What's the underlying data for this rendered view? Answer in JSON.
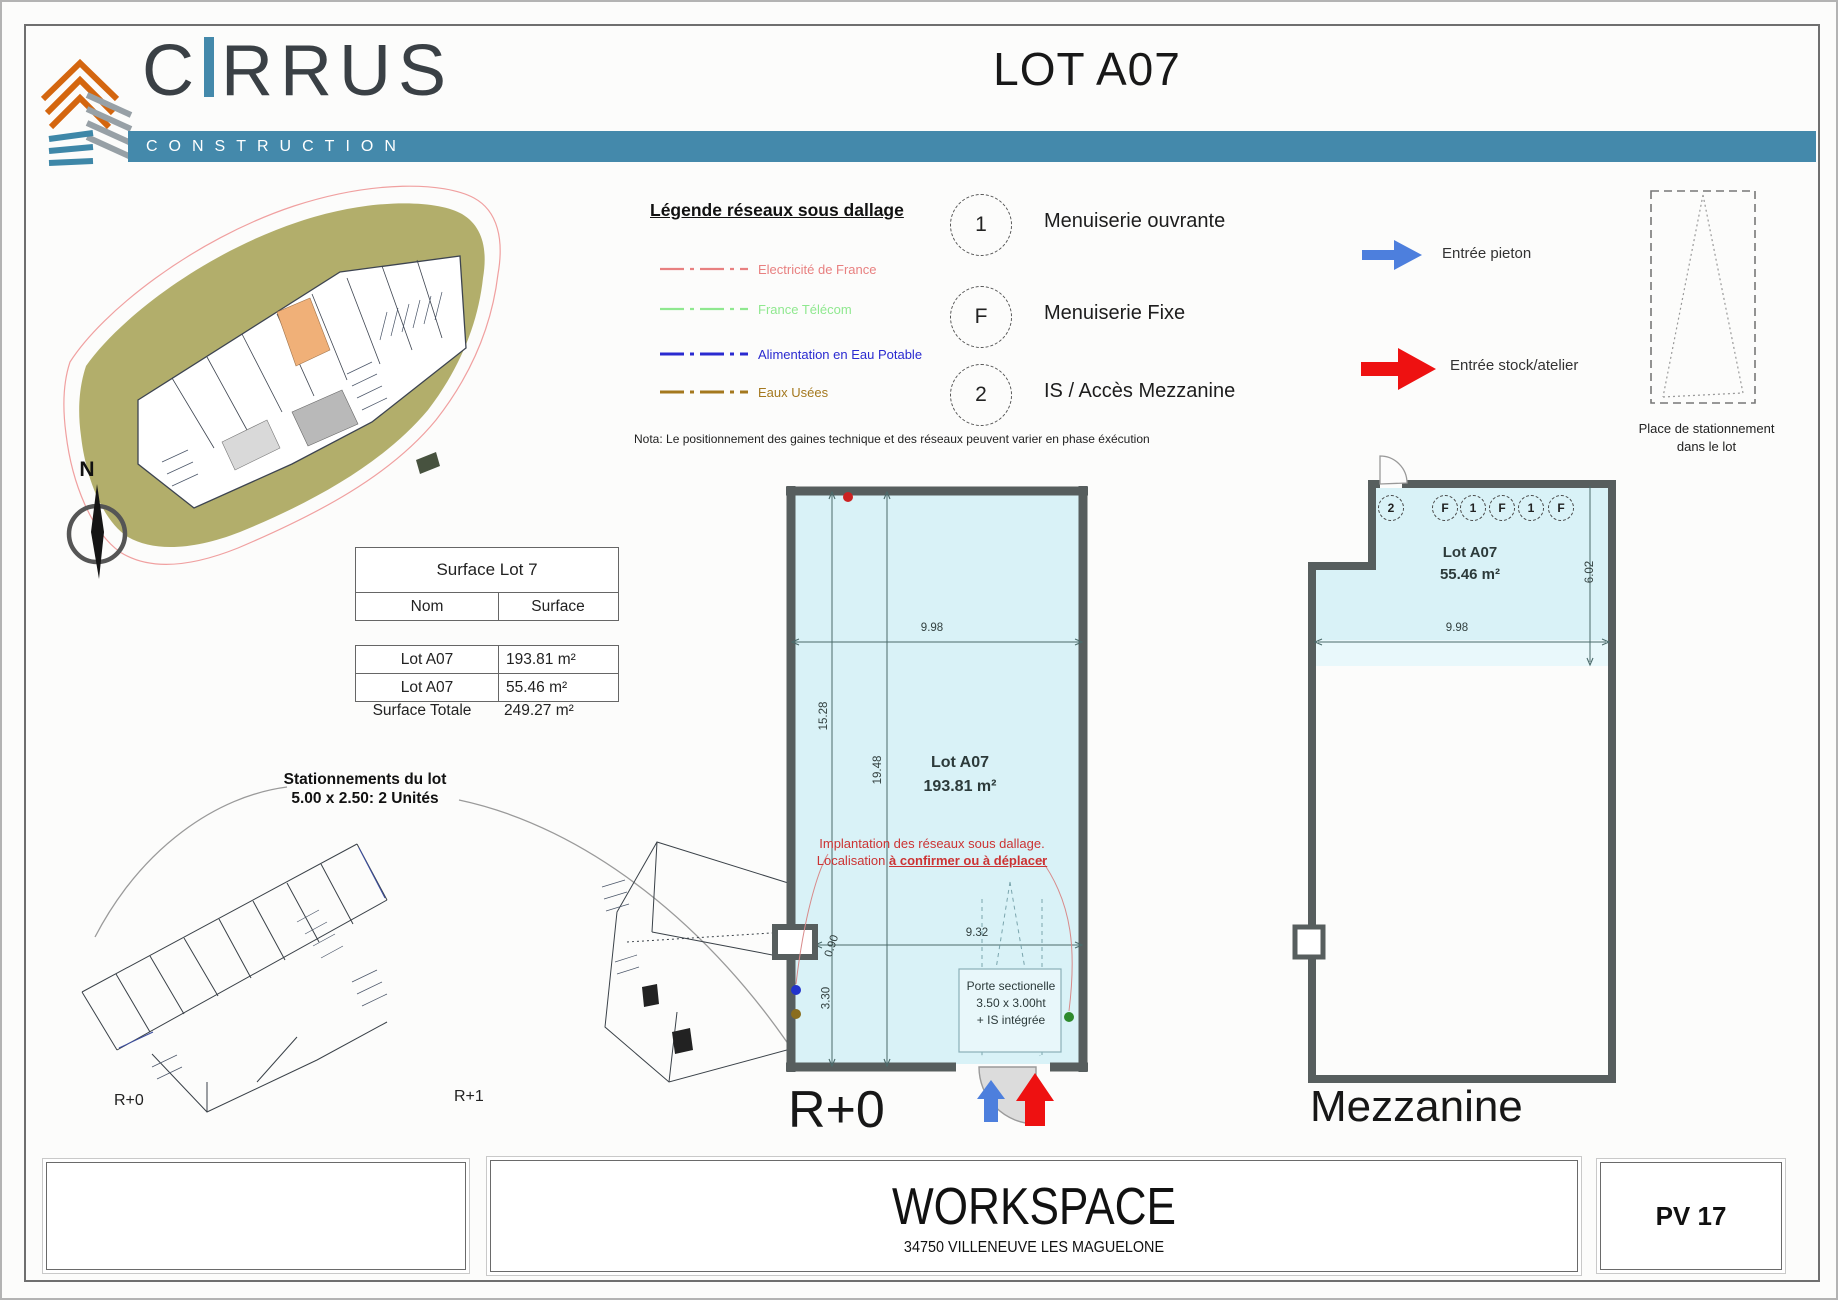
{
  "page": {
    "title": "LOT A07"
  },
  "brand": {
    "name_pre": "C",
    "name_post": "RRUS",
    "subtitle": "CONSTRUCTION"
  },
  "colors": {
    "teal": "#4489ab",
    "dark": "#3a4045",
    "plan_fill": "#d9f2f7",
    "wall": "#575e5e",
    "khaki": "#b2ae6b",
    "highlight": "#f0b078",
    "entry_blue": "#4d7fdd",
    "entry_red": "#ee1111",
    "note_red": "#cc3333"
  },
  "compass": {
    "label": "N"
  },
  "legend": {
    "title": "Légende réseaux sous dallage",
    "items": [
      {
        "label": "Electricité de France",
        "color": "#e88080"
      },
      {
        "label": "France Télécom",
        "color": "#8fe88f"
      },
      {
        "label": "Alimentation en Eau Potable",
        "color": "#2a2ad0"
      },
      {
        "label": "Eaux Usées",
        "color": "#a4781e"
      }
    ],
    "nota": "Nota: Le positionnement des gaines technique et des réseaux peuvent varier en phase éxécution"
  },
  "openings": [
    {
      "glyph": "1",
      "label": "Menuiserie ouvrante"
    },
    {
      "glyph": "F",
      "label": "Menuiserie Fixe"
    },
    {
      "glyph": "2",
      "label": "IS / Accès Mezzanine"
    }
  ],
  "entrances": {
    "pedestrian": {
      "label": "Entrée pieton"
    },
    "stock": {
      "label": "Entrée stock/atelier"
    }
  },
  "parking_spot": {
    "line1": "Place de stationnement",
    "line2": "dans le lot"
  },
  "surface_table": {
    "title": "Surface Lot 7",
    "col_name": "Nom",
    "col_surface": "Surface",
    "rows": [
      {
        "name": "Lot A07",
        "surface": "193.81 m²"
      },
      {
        "name": "Lot A07",
        "surface": "55.46 m²"
      }
    ],
    "total_label": "Surface Totale",
    "total_value": "249.27 m²"
  },
  "parking_note": {
    "line1": "Stationnements du lot",
    "line2": "5.00 x 2.50: 2 Unités"
  },
  "key_plans": {
    "left": "R+0",
    "right": "R+1"
  },
  "plan_r0": {
    "label": "R+0",
    "lot_name": "Lot A07",
    "lot_area": "193.81 m²",
    "dim_width_total": "9.98",
    "dim_height_left": "15.28",
    "dim_height_mid": "19.48",
    "dim_width_lower": "9.32",
    "dim_small": "0.90",
    "dim_330": "3.30",
    "note_red_1": "Implantation des réseaux sous dallage.",
    "note_red_2a": "Localisation ",
    "note_red_2b": "à confirmer ou à déplacer",
    "door_box": {
      "line1": "Porte sectionelle",
      "line2": "3.50 x 3.00ht",
      "line3": "+ IS intégrée"
    }
  },
  "plan_mezz": {
    "label": "Mezzanine",
    "lot_name": "Lot A07",
    "lot_area": "55.46 m²",
    "dim_width": "9.98",
    "dim_height": "6.02",
    "circles": [
      "2",
      "F",
      "1",
      "F",
      "1",
      "F"
    ]
  },
  "title_block": {
    "project": "WORKSPACE",
    "address": "34750 VILLENEUVE LES MAGUELONE",
    "sheet": "PV 17"
  }
}
